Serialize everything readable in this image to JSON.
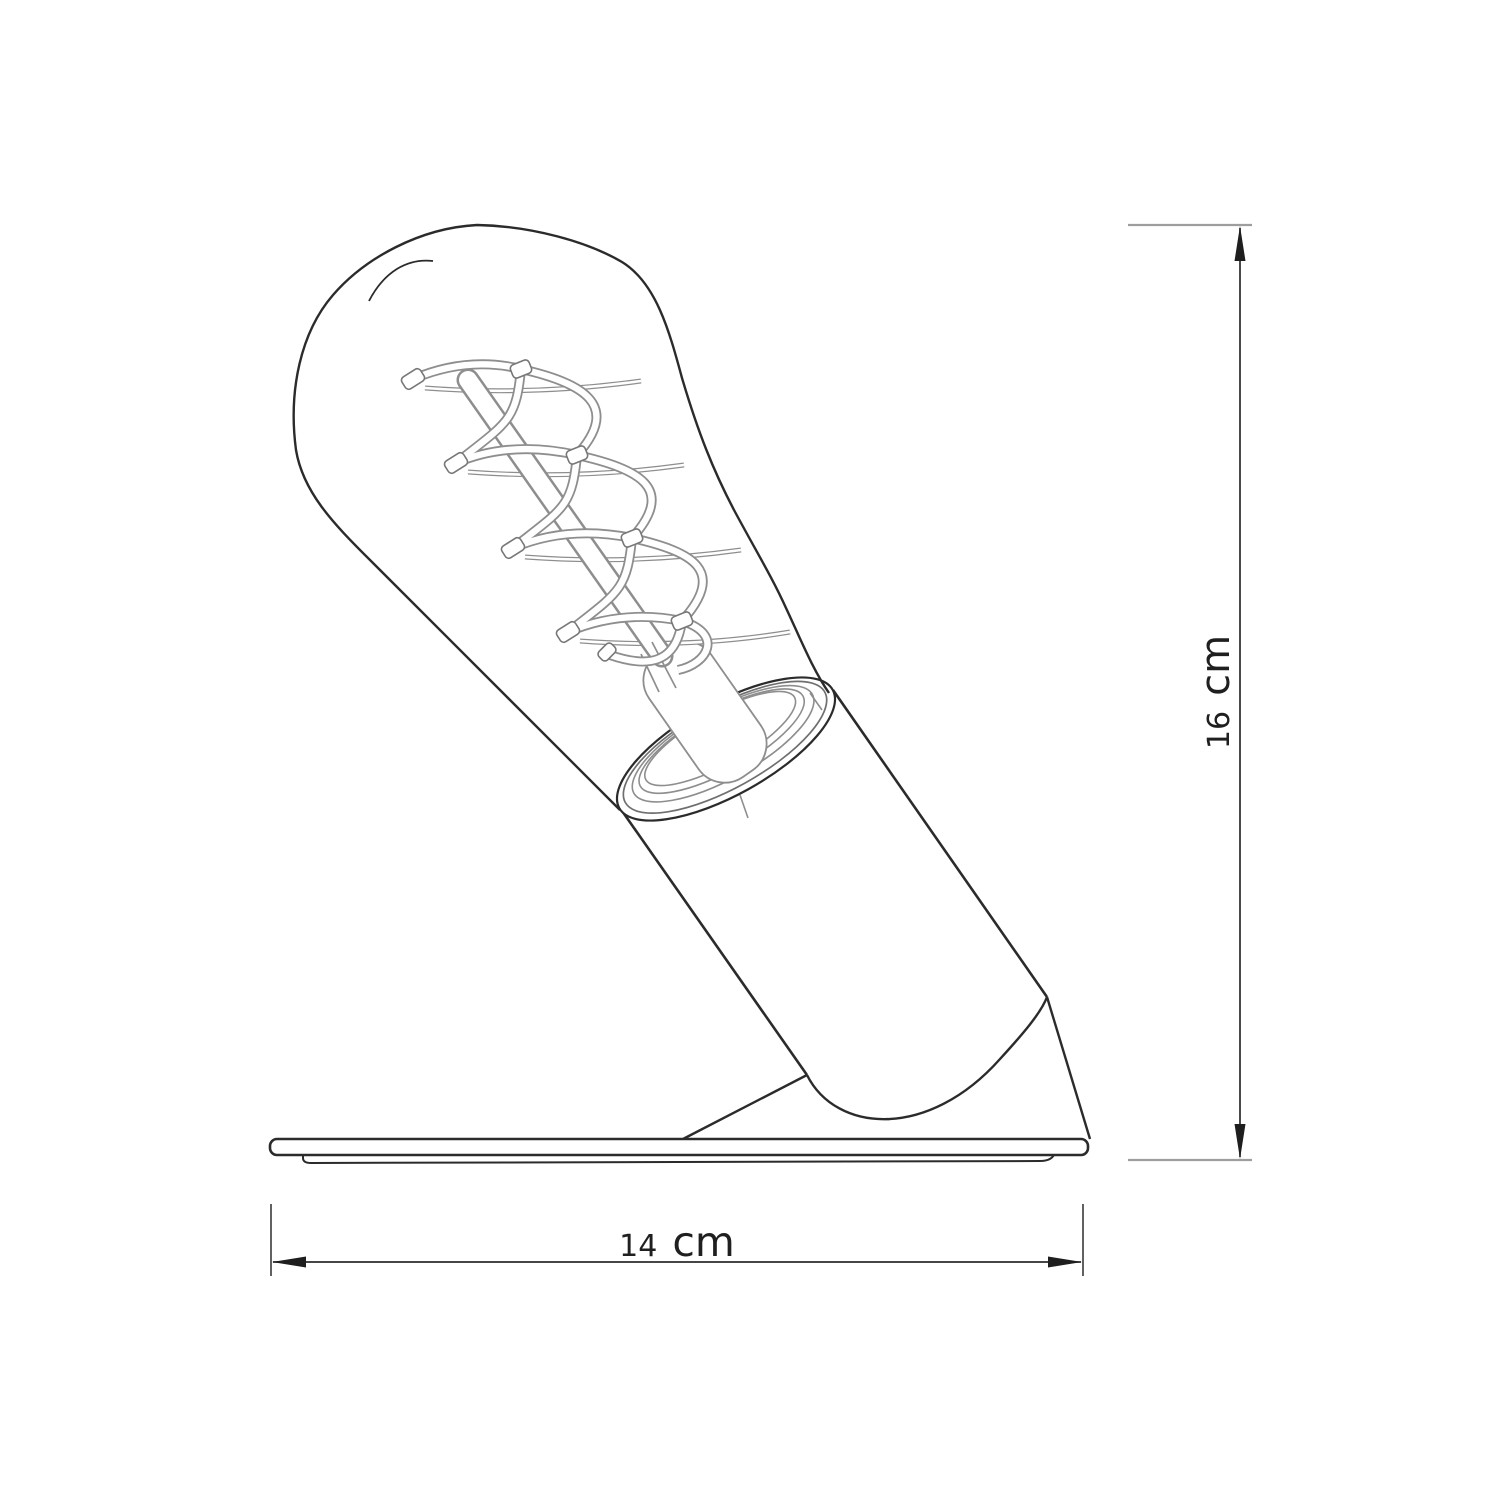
{
  "colors": {
    "background": "#ffffff",
    "line": "#2b2b2b",
    "light_line": "#8e8e8e",
    "text": "#1f1f1f"
  },
  "dims": {
    "height": {
      "value": "16",
      "unit": "cm",
      "label": "16 cm"
    },
    "width": {
      "value": "14",
      "unit": "cm",
      "label": "14 cm"
    }
  }
}
